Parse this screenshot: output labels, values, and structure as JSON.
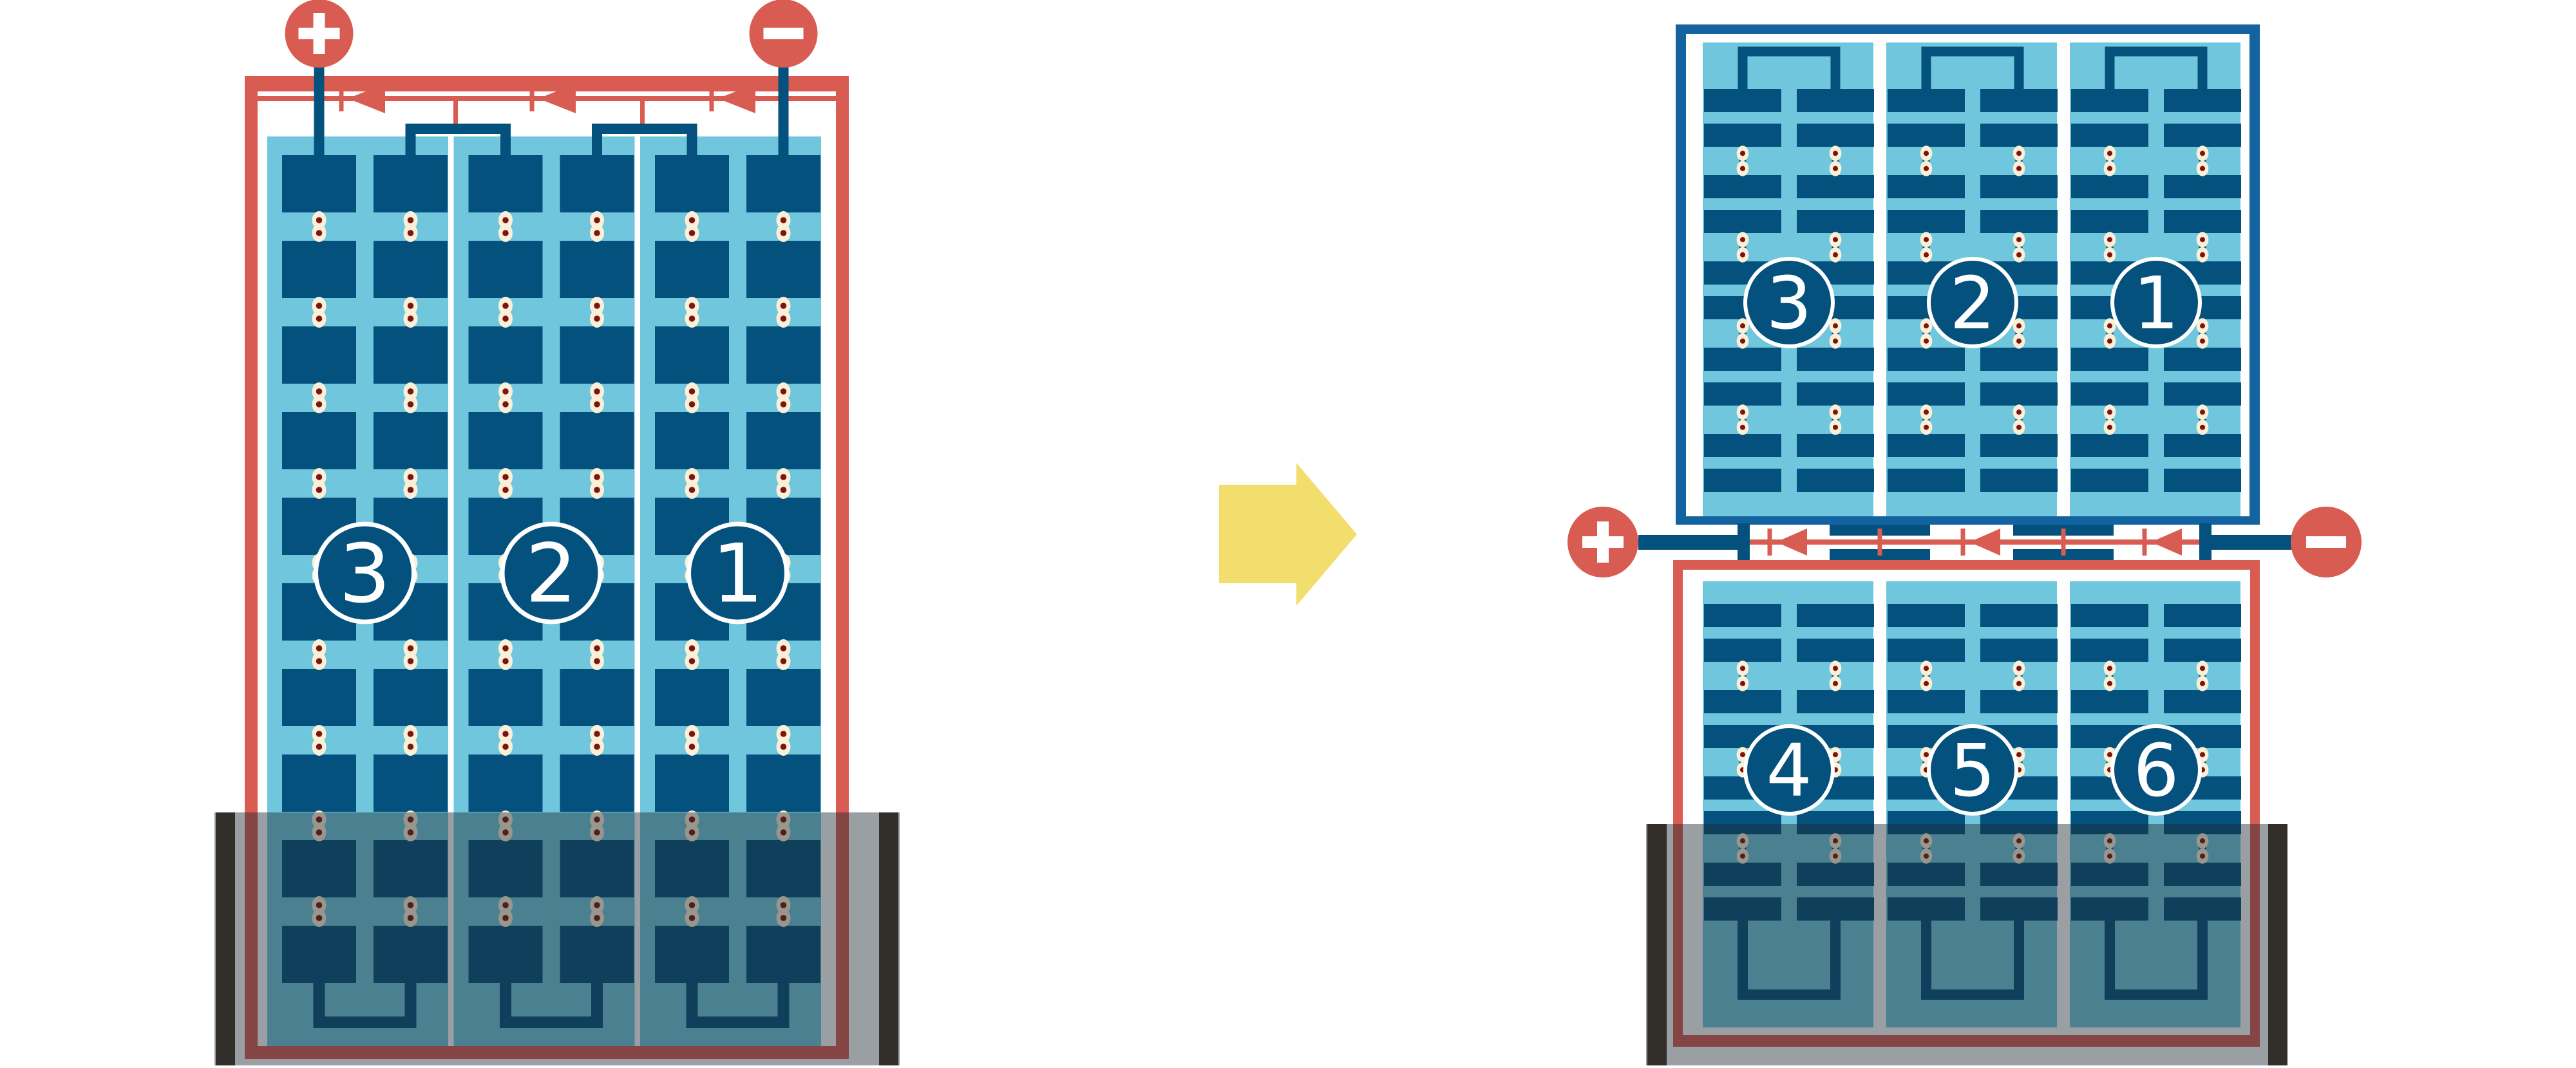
{
  "colors": {
    "red": "#D95C53",
    "navy": "#04517E",
    "frame_blue": "#1363A0",
    "light_blue": "#6FC6DD",
    "cream": "#FAF0D7",
    "solder_dot": "#7D1412",
    "separator_white": "#FFFFFF",
    "glyph_white": "#FFFFFF",
    "number_text": "#FFFFFF",
    "flood_overlay": "rgba(30,42,52,0.45)",
    "flood_edge_bar": "#322F2B",
    "arrow_yellow": "#F2DE6C"
  },
  "left_panel": {
    "terminal_positive": "+",
    "terminal_negative": "−",
    "string_labels": [
      "3",
      "2",
      "1"
    ],
    "strings": 3,
    "cell_columns_per_string": 2,
    "cell_rows": 10,
    "bypass_diode_count": 3,
    "flooded": true
  },
  "right_top_panel": {
    "string_labels": [
      "3",
      "2",
      "1"
    ],
    "strings": 3,
    "cell_columns_per_string": 2,
    "cell_row_pairs": 5,
    "flooded": false
  },
  "right_bottom_panel": {
    "terminal_positive": "+",
    "terminal_negative": "−",
    "string_labels": [
      "4",
      "5",
      "6"
    ],
    "strings": 3,
    "cell_columns_per_string": 2,
    "cell_row_pairs": 4,
    "bypass_diode_count": 3,
    "flooded": true
  },
  "transform_arrow": {
    "direction": "right"
  }
}
